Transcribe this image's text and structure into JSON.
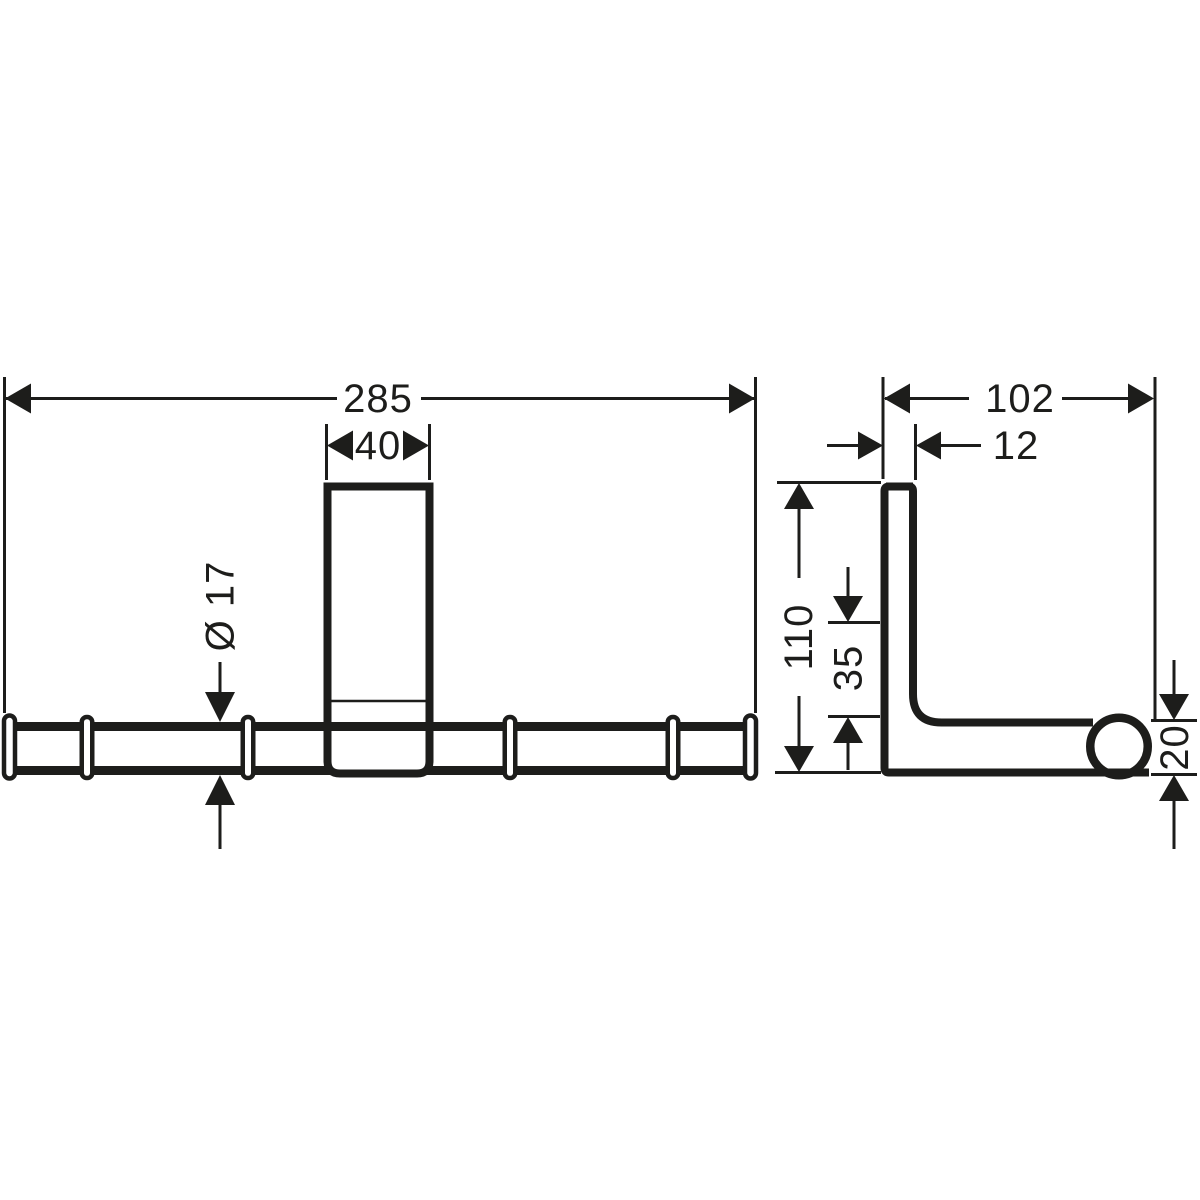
{
  "document": {
    "kind": "technical dimension drawing",
    "background_color": "#ffffff",
    "line_color": "#1d1d1b"
  },
  "front_view": {
    "overall_width_label": "285",
    "bracket_width_label": "40",
    "bar_diameter_label": "Ø 17"
  },
  "side_view": {
    "depth_label": "102",
    "plate_thickness_label": "12",
    "height_label": "110",
    "offset_label": "35",
    "bar_end_height_label": "20"
  }
}
